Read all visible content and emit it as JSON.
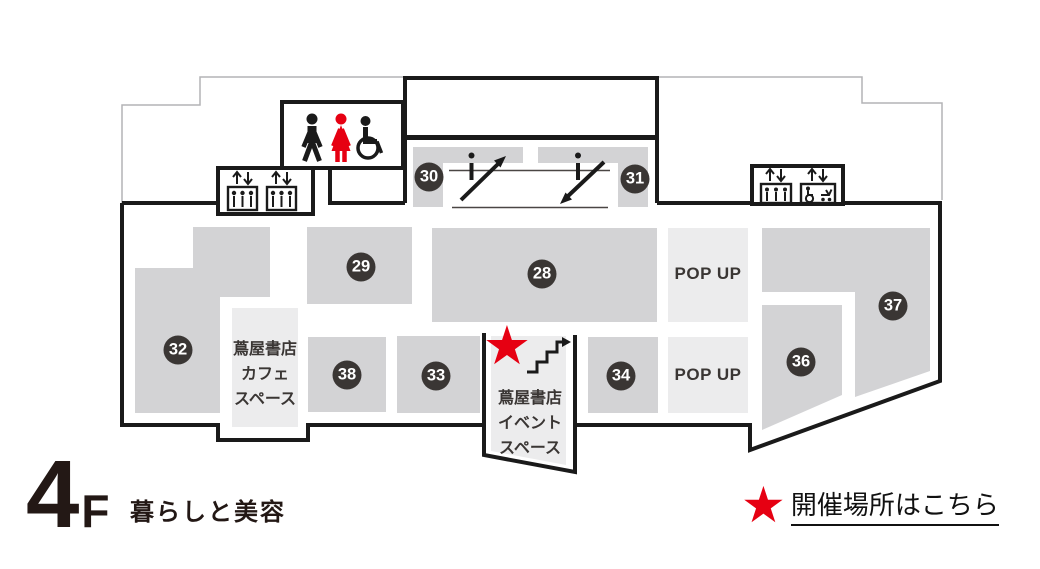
{
  "floor": {
    "level": "4",
    "suffix": "F",
    "category": "暮らしと美容"
  },
  "legend": {
    "star_glyph": "★",
    "text": "開催場所はこちら"
  },
  "event_marker": {
    "glyph": "★"
  },
  "popup": {
    "label": "POP UP"
  },
  "cafe_space": {
    "line1": "蔦屋書店",
    "line2": "カフェ",
    "line3": "スペース"
  },
  "event_space": {
    "line1": "蔦屋書店",
    "line2": "イベント",
    "line3": "スペース"
  },
  "areas": [
    {
      "number": "28"
    },
    {
      "number": "29"
    },
    {
      "number": "30"
    },
    {
      "number": "31"
    },
    {
      "number": "32"
    },
    {
      "number": "33"
    },
    {
      "number": "34"
    },
    {
      "number": "36"
    },
    {
      "number": "37"
    },
    {
      "number": "38"
    }
  ],
  "icon_names": [
    "men-restroom-icon",
    "women-restroom-icon",
    "wheelchair-icon",
    "elevator-icon",
    "accessible-elevator-icon",
    "escalator-up-icon",
    "escalator-down-icon",
    "stairs-icon",
    "event-location-star-icon",
    "legend-star-icon"
  ],
  "colors": {
    "outline": "#1a1a1a",
    "thin_outline": "#b4b4b6",
    "area_fill": "#d3d3d5",
    "light_fill": "#ececed",
    "badge_fill": "#3a3634",
    "accent_red": "#e60012",
    "title_color": "#231815",
    "text_dark": "#3a3634"
  }
}
